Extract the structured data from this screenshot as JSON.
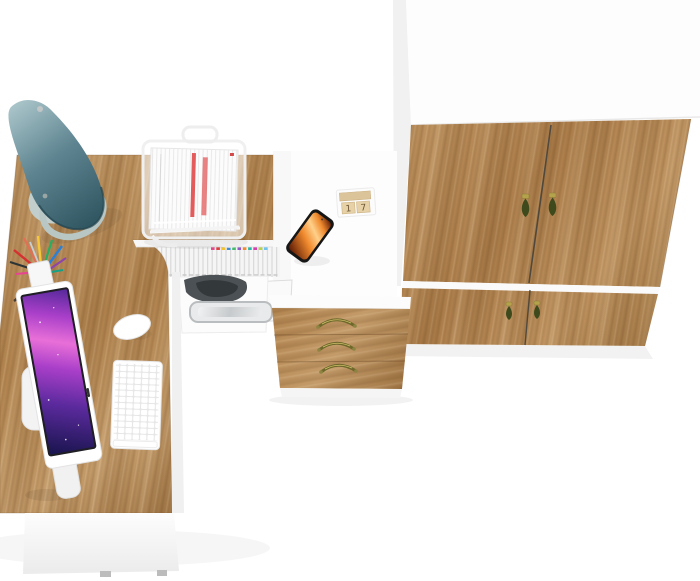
{
  "scene": {
    "description": "Top-down 3D render of a home-office furniture set: L-shaped oak and white desk with all-in-one computer, keyboard, mouse, teal desk lamp, wire document stand with papers, pencil cup, smartphone, wooden block calendar, hutch shelf with binders, printer, three-drawer pedestal and a two-door oak wardrobe",
    "background": "#ffffff"
  },
  "palette": {
    "wood_light": "#c59c6a",
    "wood_mid": "#b3854f",
    "wood_dark": "#9a6f3e",
    "wardrobe_wood_light": "#c29662",
    "wardrobe_wood_mid": "#ae7f4b",
    "wardrobe_wood_dark": "#9c7240",
    "white_surface": "#fdfdfd",
    "panel_shade": "#ebebeb",
    "lamp_light": "#a9c4c9",
    "lamp_mid": "#5d8490",
    "lamp_dark": "#2d535f",
    "lamp_base": "#c2cecb",
    "screen_deep": "#1b1550",
    "screen_violet": "#5b2a9d",
    "screen_magenta": "#a93fc9",
    "screen_pink": "#e86fd8",
    "phone_dark": "#5a1703",
    "phone_orange": "#f08a2e",
    "phone_light": "#ffd08a",
    "brass": "#6e682b",
    "pendant_green": "#3e4a1c",
    "pendant_cap": "#b5a24c",
    "red_stripe": "#e35b5b"
  },
  "book_tabs": [
    "#e84a8f",
    "#e04040",
    "#f2c230",
    "#3f8fd4",
    "#46b96a",
    "#8e5bc6",
    "#ef8b2e",
    "#2ab8a8",
    "#d43fb0",
    "#b7d244",
    "#6fc3ef"
  ],
  "calendar": {
    "digits": [
      "1",
      "7"
    ]
  },
  "objects": [
    {
      "name": "desk-lamp",
      "label": "teal desk lamp"
    },
    {
      "name": "l-shaped-desk",
      "label": "oak and white L-shaped desk"
    },
    {
      "name": "monitor",
      "label": "all-in-one computer"
    },
    {
      "name": "keyboard",
      "label": "white keyboard"
    },
    {
      "name": "mouse",
      "label": "white mouse"
    },
    {
      "name": "pencil-cup",
      "label": "pencil cup with pens"
    },
    {
      "name": "document-stand",
      "label": "wire document stand with papers"
    },
    {
      "name": "book-shelf",
      "label": "hutch shelf with binders"
    },
    {
      "name": "printer",
      "label": "printer under desk"
    },
    {
      "name": "smartphone",
      "label": "smartphone"
    },
    {
      "name": "block-calendar",
      "label": "wooden block calendar"
    },
    {
      "name": "drawer-pedestal",
      "label": "three-drawer pedestal"
    },
    {
      "name": "wardrobe",
      "label": "two-door oak wardrobe"
    }
  ]
}
